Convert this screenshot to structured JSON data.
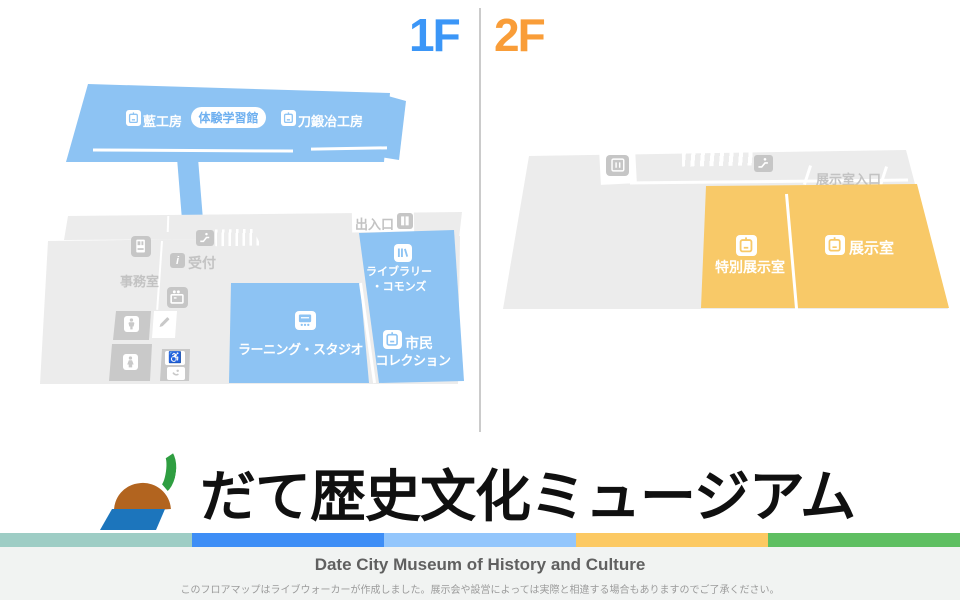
{
  "header": {
    "floor1": "1F",
    "floor2": "2F"
  },
  "floor1": {
    "workshops": {
      "ai_kobo": "藍工房",
      "taiken_gakushukan": "体験学習館",
      "katana_kaji_kobo": "刀鍛冶工房"
    },
    "labels": {
      "entrance": "出入口",
      "reception": "受付",
      "office": "事務室"
    },
    "rooms": {
      "library_line1": "ライブラリー",
      "library_line2": "・コモンズ",
      "learning_studio": "ラーニング・スタジオ",
      "citizen_line1": "市民",
      "citizen_line2": "コレクション"
    }
  },
  "floor2": {
    "labels": {
      "exhibit_entrance": "展示室入口"
    },
    "rooms": {
      "special_exhibit": "特別展示室",
      "exhibit": "展示室"
    }
  },
  "branding": {
    "title_jp": "だて歴史文化ミュージアム",
    "title_en": "Date City Museum of History and Culture",
    "disclaimer": "このフロアマップはライブウォーカーが作成しました。展示会や設営によっては実際と相違する場合もありますのでご了承ください。"
  },
  "icons": {
    "info_glyph": "i",
    "wheelchair_glyph": "♿"
  },
  "colors": {
    "floor1_accent": "#3b96f7",
    "floor2_accent": "#f99d38",
    "floor1_room_fill": "#8dc3f3",
    "floor2_room_fill": "#f8c968",
    "floor_base_fill": "#ececec",
    "stripe": [
      "#9ecdc5",
      "#3e8ef6",
      "#93c6fc",
      "#fcc963",
      "#5fbf62"
    ]
  }
}
